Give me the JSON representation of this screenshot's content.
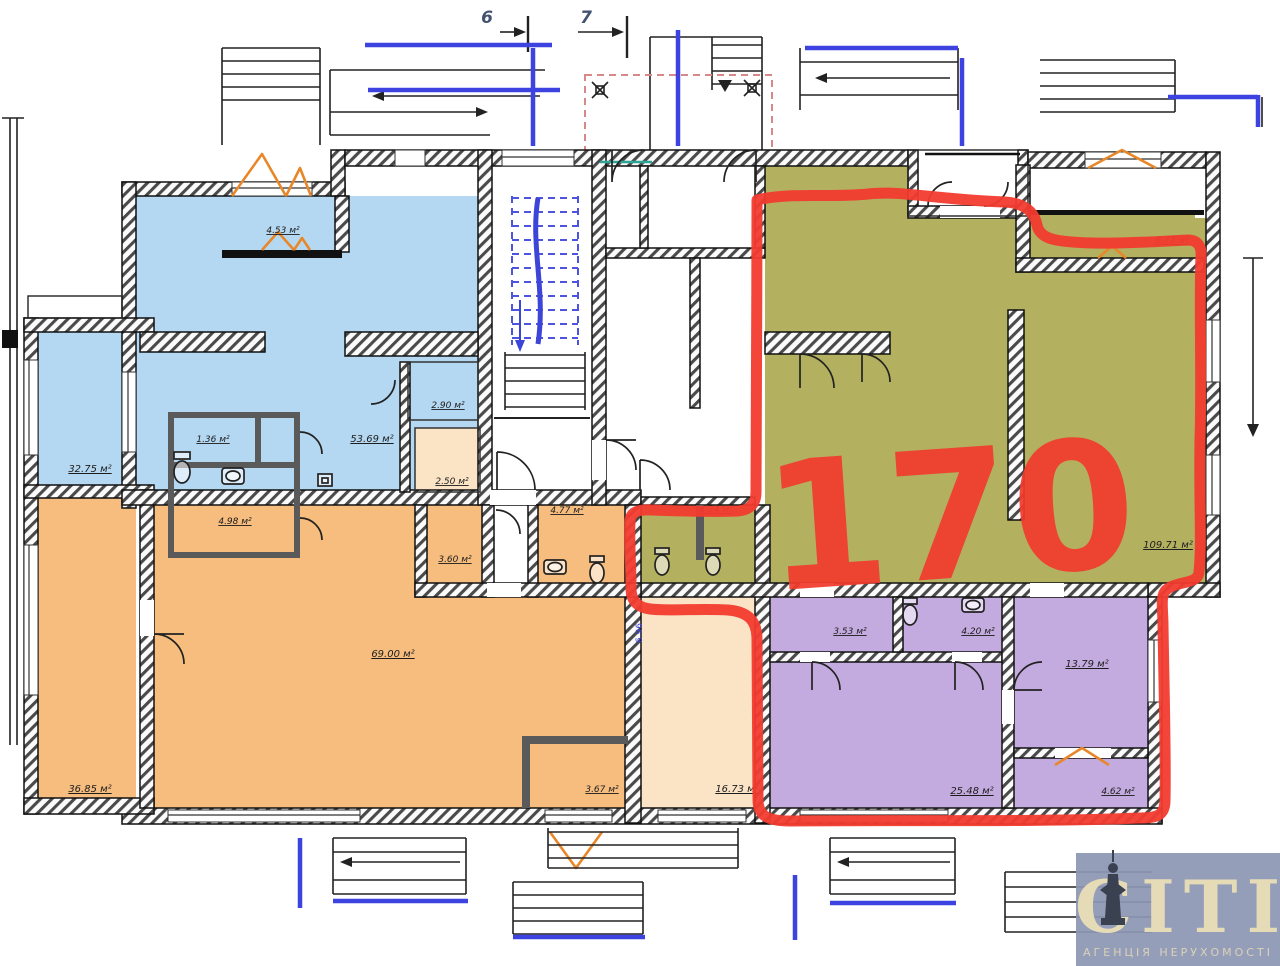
{
  "plan": {
    "grid_markers": {
      "m6": "6",
      "m7": "7"
    },
    "highlight": {
      "number": "170",
      "color": "#f23b2e"
    },
    "unit_dim": "6.96",
    "rooms": {
      "blue_closet": "4.53 м²",
      "blue_main": "53.69 м²",
      "blue_left": "32.75 м²",
      "wc_small": "1.36 м²",
      "wc_main": "4.98 м²",
      "blue_niche": "2.90 м²",
      "peach_small": "2.50 м²",
      "orange_small": "3.60 м²",
      "orange_wc": "4.77 м²",
      "olive_wc": "4.24 м²",
      "orange_main": "69.00 м²",
      "orange_left": "36.85 м²",
      "olive_main": "109.71 м²",
      "olive_niche": "6.77 м²",
      "purple_wc_left": "3.53 м²",
      "purple_wc_right": "4.20 м²",
      "purple_right": "13.79 м²",
      "purple_main": "25.48 м²",
      "purple_small": "4.62 м²",
      "peach_hall": "16.73 м²",
      "orange_bottom": "3.67 м²"
    },
    "colors": {
      "blue": "#b5d8f2",
      "orange": "#f6bd7e",
      "peach": "#fbe3c6",
      "olive": "#b3b060",
      "purple": "#c4abdf",
      "accent_blue": "#3d43e0",
      "red_outline": "#f23b2e"
    }
  },
  "logo": {
    "brand": "CITI",
    "tagline": "АГЕНЦІЯ НЕРУХОМОСТІ"
  }
}
